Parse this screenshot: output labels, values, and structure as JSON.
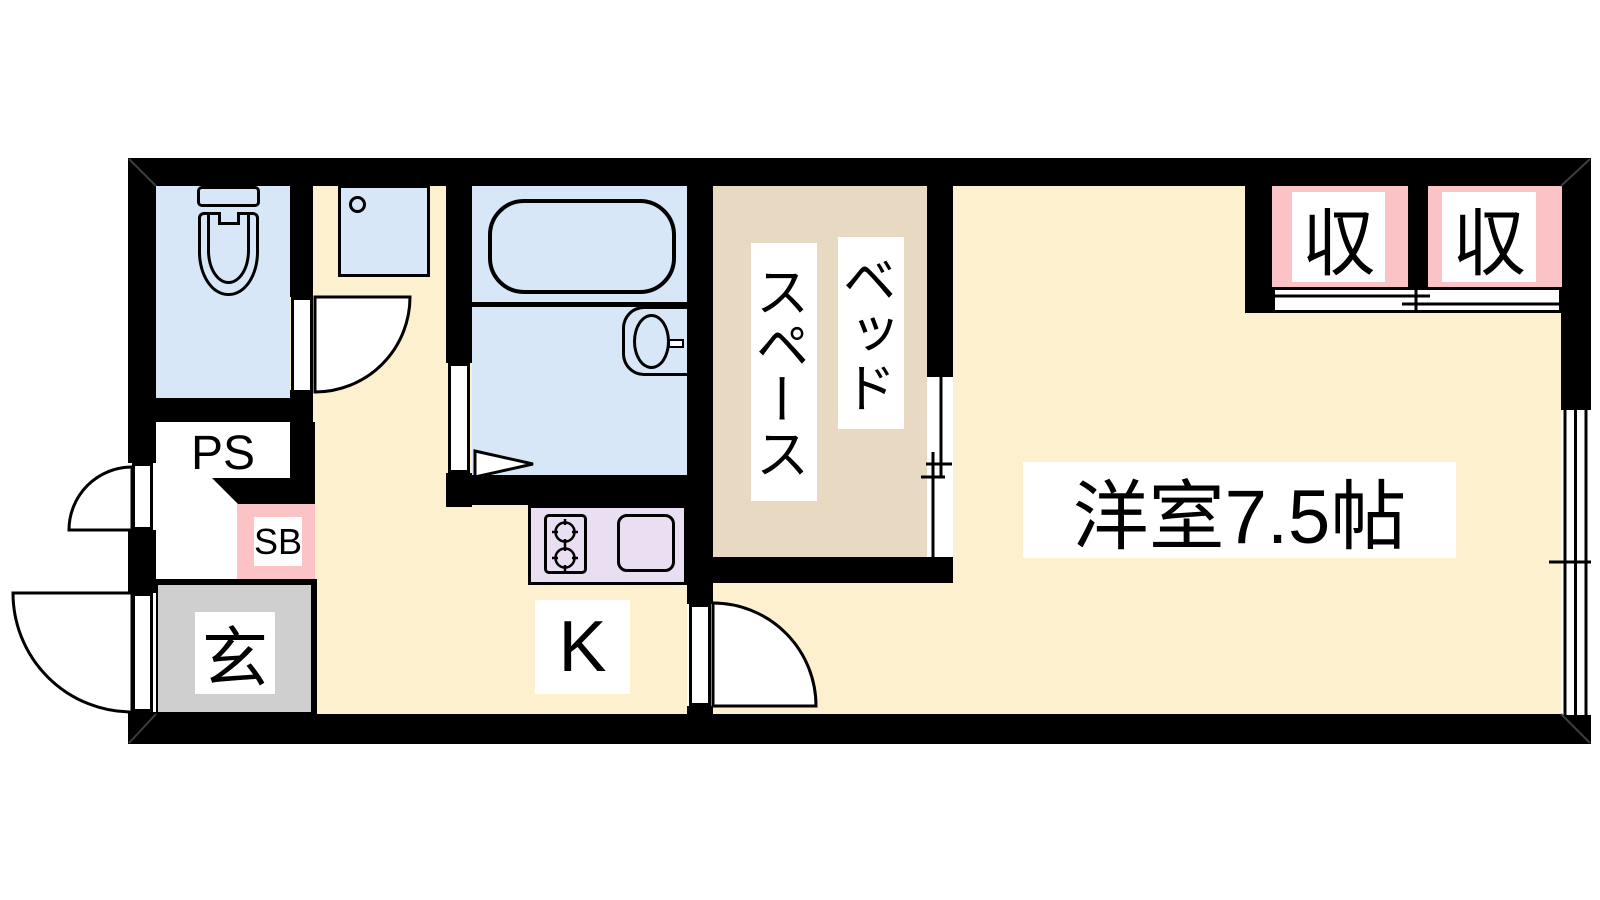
{
  "floorplan": {
    "labels": {
      "western_room": "洋室7.5帖",
      "bed_space_line1": "ベッド",
      "bed_space_line2": "スペース",
      "kitchen": "K",
      "entrance": "玄",
      "pipe_space": "PS",
      "shoe_box": "SB",
      "closet_left": "収",
      "closet_right": "収"
    },
    "colors": {
      "wall": "#000000",
      "floor_cream": "#FCF0CF",
      "water_area_blue": "#D8E7F8",
      "bed_space_tan": "#E8DAC2",
      "closet_pink": "#FBC3C6",
      "kitchen_counter_lavender": "#E9DEF2",
      "entrance_gray": "#CFCFCF"
    },
    "fixtures": [
      "toilet",
      "washbasin",
      "bathtub",
      "vanity-basin",
      "folding-door",
      "gas-stove",
      "kitchen-sink",
      "hinged-door",
      "sliding-door",
      "window"
    ]
  }
}
